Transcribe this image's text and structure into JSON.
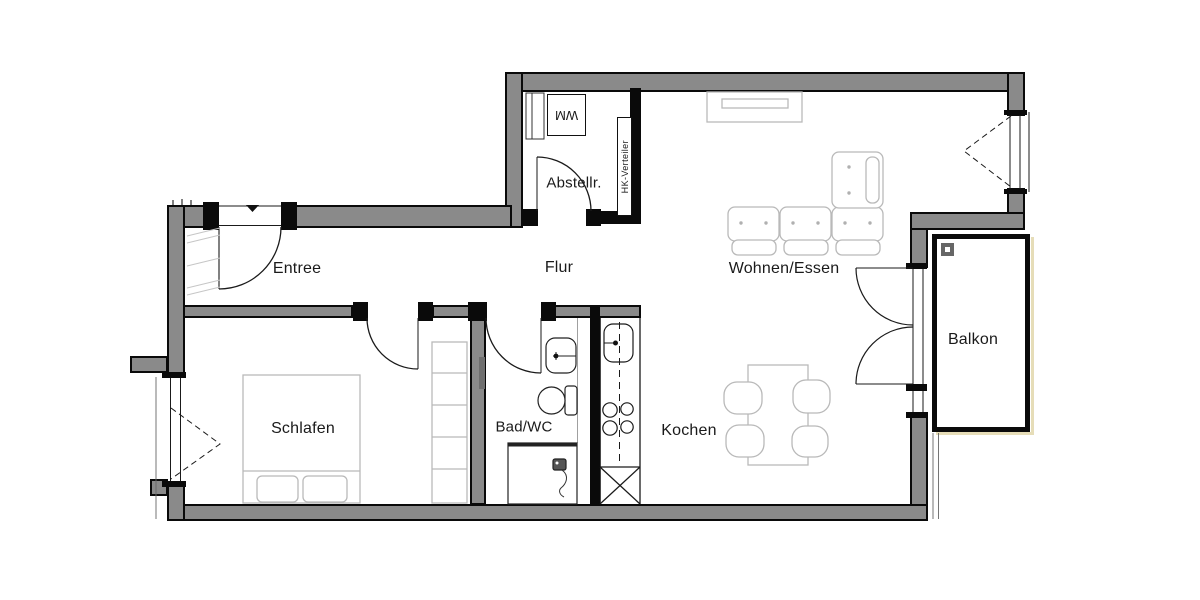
{
  "drawing": {
    "type": "apartment-floor-plan"
  },
  "rooms": {
    "entree": {
      "label": "Entree"
    },
    "flur": {
      "label": "Flur"
    },
    "abstellraum": {
      "label": "Abstellr."
    },
    "wohnen_essen": {
      "label": "Wohnen/Essen"
    },
    "schlafen": {
      "label": "Schlafen"
    },
    "bad_wc": {
      "label": "Bad/WC"
    },
    "kochen": {
      "label": "Kochen"
    },
    "balkon": {
      "label": "Balkon"
    }
  },
  "annotations": {
    "washing_machine": "WM",
    "heating_distributor": "HK-Verteiler"
  },
  "colors": {
    "wall_fill": "#8a8a8a",
    "wall_edge": "#0a0a0a",
    "furniture_line": "#b9b9b9",
    "balcony_shadow": "#e6ddb8"
  }
}
